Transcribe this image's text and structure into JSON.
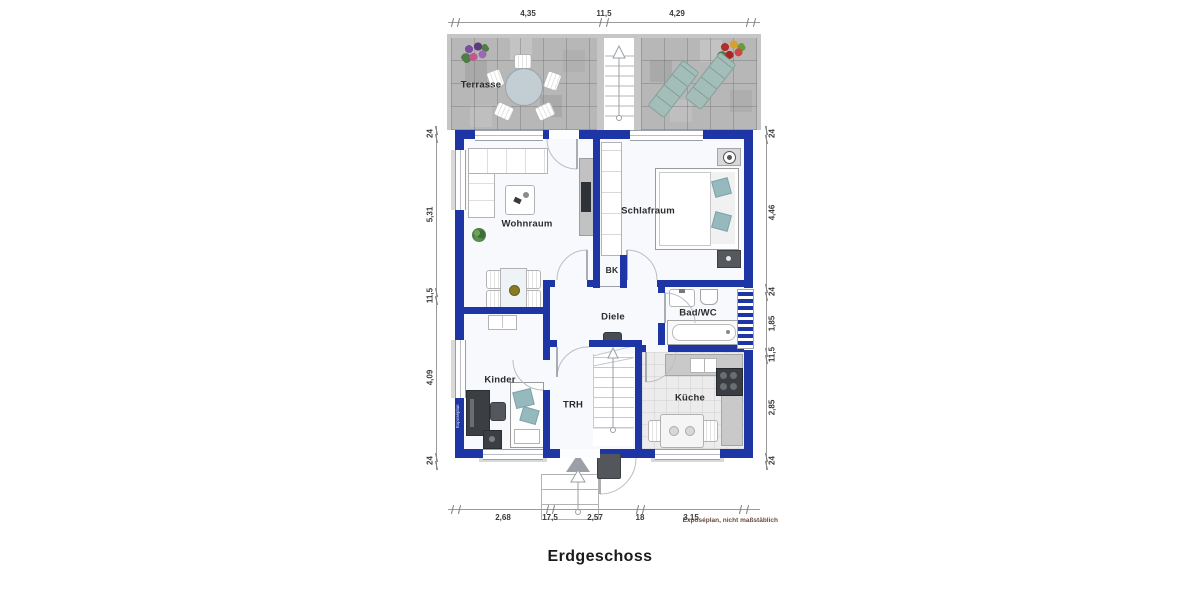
{
  "title": "Erdgeschoss",
  "footnote": "Exposéplan, nicht maßstäblich",
  "watermark": "Exposéplan",
  "rooms": {
    "terrasse": "Terrasse",
    "wohnraum": "Wohnraum",
    "schlafraum": "Schlafraum",
    "bk": "BK",
    "diele": "Diele",
    "badwc": "Bad/WC",
    "kinder": "Kinder",
    "trh": "TRH",
    "kueche": "Küche"
  },
  "dimensions": {
    "top": [
      "4,35",
      "11,5",
      "4,29"
    ],
    "left": [
      "24",
      "5,31",
      "11,5",
      "4,09",
      "24"
    ],
    "right": [
      "24",
      "4,46",
      "24",
      "1,85",
      "11,5",
      "2,85",
      "24"
    ],
    "bottom": [
      "2,68",
      "17,5",
      "2,57",
      "18",
      "3,15"
    ]
  },
  "colors": {
    "wall": "#1e35a6",
    "terrace": "#b7b7b7",
    "accent_teal": "#96b9be"
  }
}
